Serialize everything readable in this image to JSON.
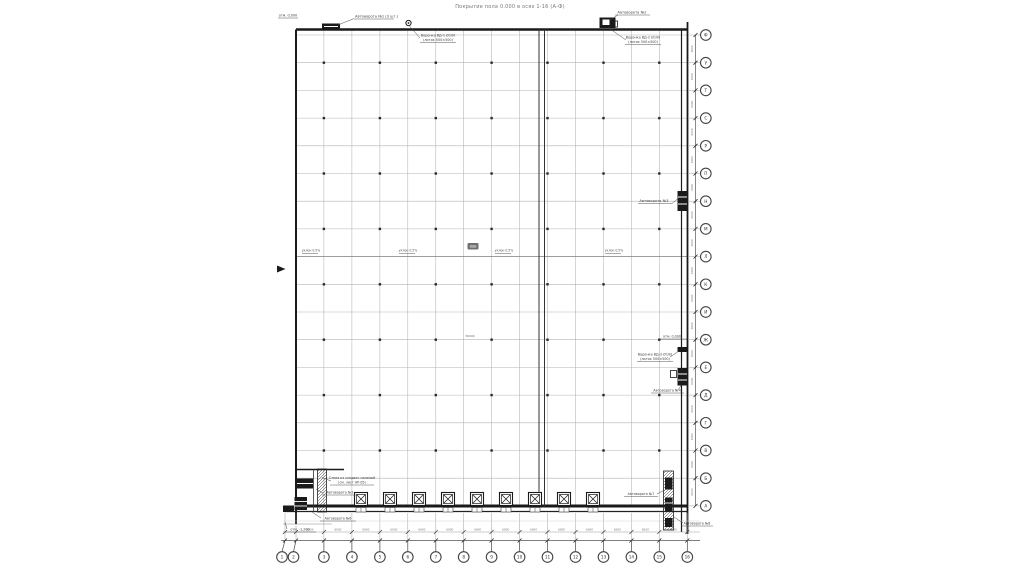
{
  "title": "Покрытие пола 0.000 в осях 1-16 (А-Ф)",
  "axes": {
    "bottom": [
      "1",
      "2",
      "3",
      "4",
      "5",
      "6",
      "7",
      "8",
      "9",
      "10",
      "11",
      "12",
      "13",
      "14",
      "15",
      "16"
    ],
    "right": [
      "Ф",
      "У",
      "Т",
      "С",
      "Р",
      "П",
      "Н",
      "М",
      "Л",
      "К",
      "И",
      "Ж",
      "Е",
      "Д",
      "Г",
      "В",
      "Б",
      "А"
    ]
  },
  "annotations": {
    "top_left_elev": "отм. 0,000",
    "gate1": "Автоворота №1 (3 шт.)",
    "drain1_l1": "Воронка ВД-1 Ø100",
    "drain1_l2": "(лоток 500×500)",
    "gate2": "Автоворота №2",
    "drain2_l1": "Воронка ВД-2 Ø100",
    "drain2_l2": "(лоток 500×500)",
    "gate3": "Автоворота №3",
    "elev_right": "отм. 0,000",
    "drain3_l1": "Воронка ВД-3 Ø100",
    "drain3_l2": "(лоток 500×500)",
    "gate4": "Автоворота №4",
    "wall_note_l1": "Стена из сэндвич-панелей",
    "wall_note_l2": "(см. лист АР-05)",
    "gate5": "Автоворота №5",
    "gate6": "Автоворота №6",
    "elev_bl": "отм. -1,200",
    "gate7": "Автоворота №7",
    "gate8": "Автоворота №8",
    "slope": "уклон 0,5%",
    "dim_center": "30000",
    "dim_segment": "6000"
  },
  "colors": {
    "line": "#1a1a1a",
    "grid": "#b3b3b3",
    "grid_dark": "#7d7d7d",
    "dim": "#666666",
    "ann_text": "#444444",
    "title_text": "#777777",
    "bg": "#ffffff"
  }
}
